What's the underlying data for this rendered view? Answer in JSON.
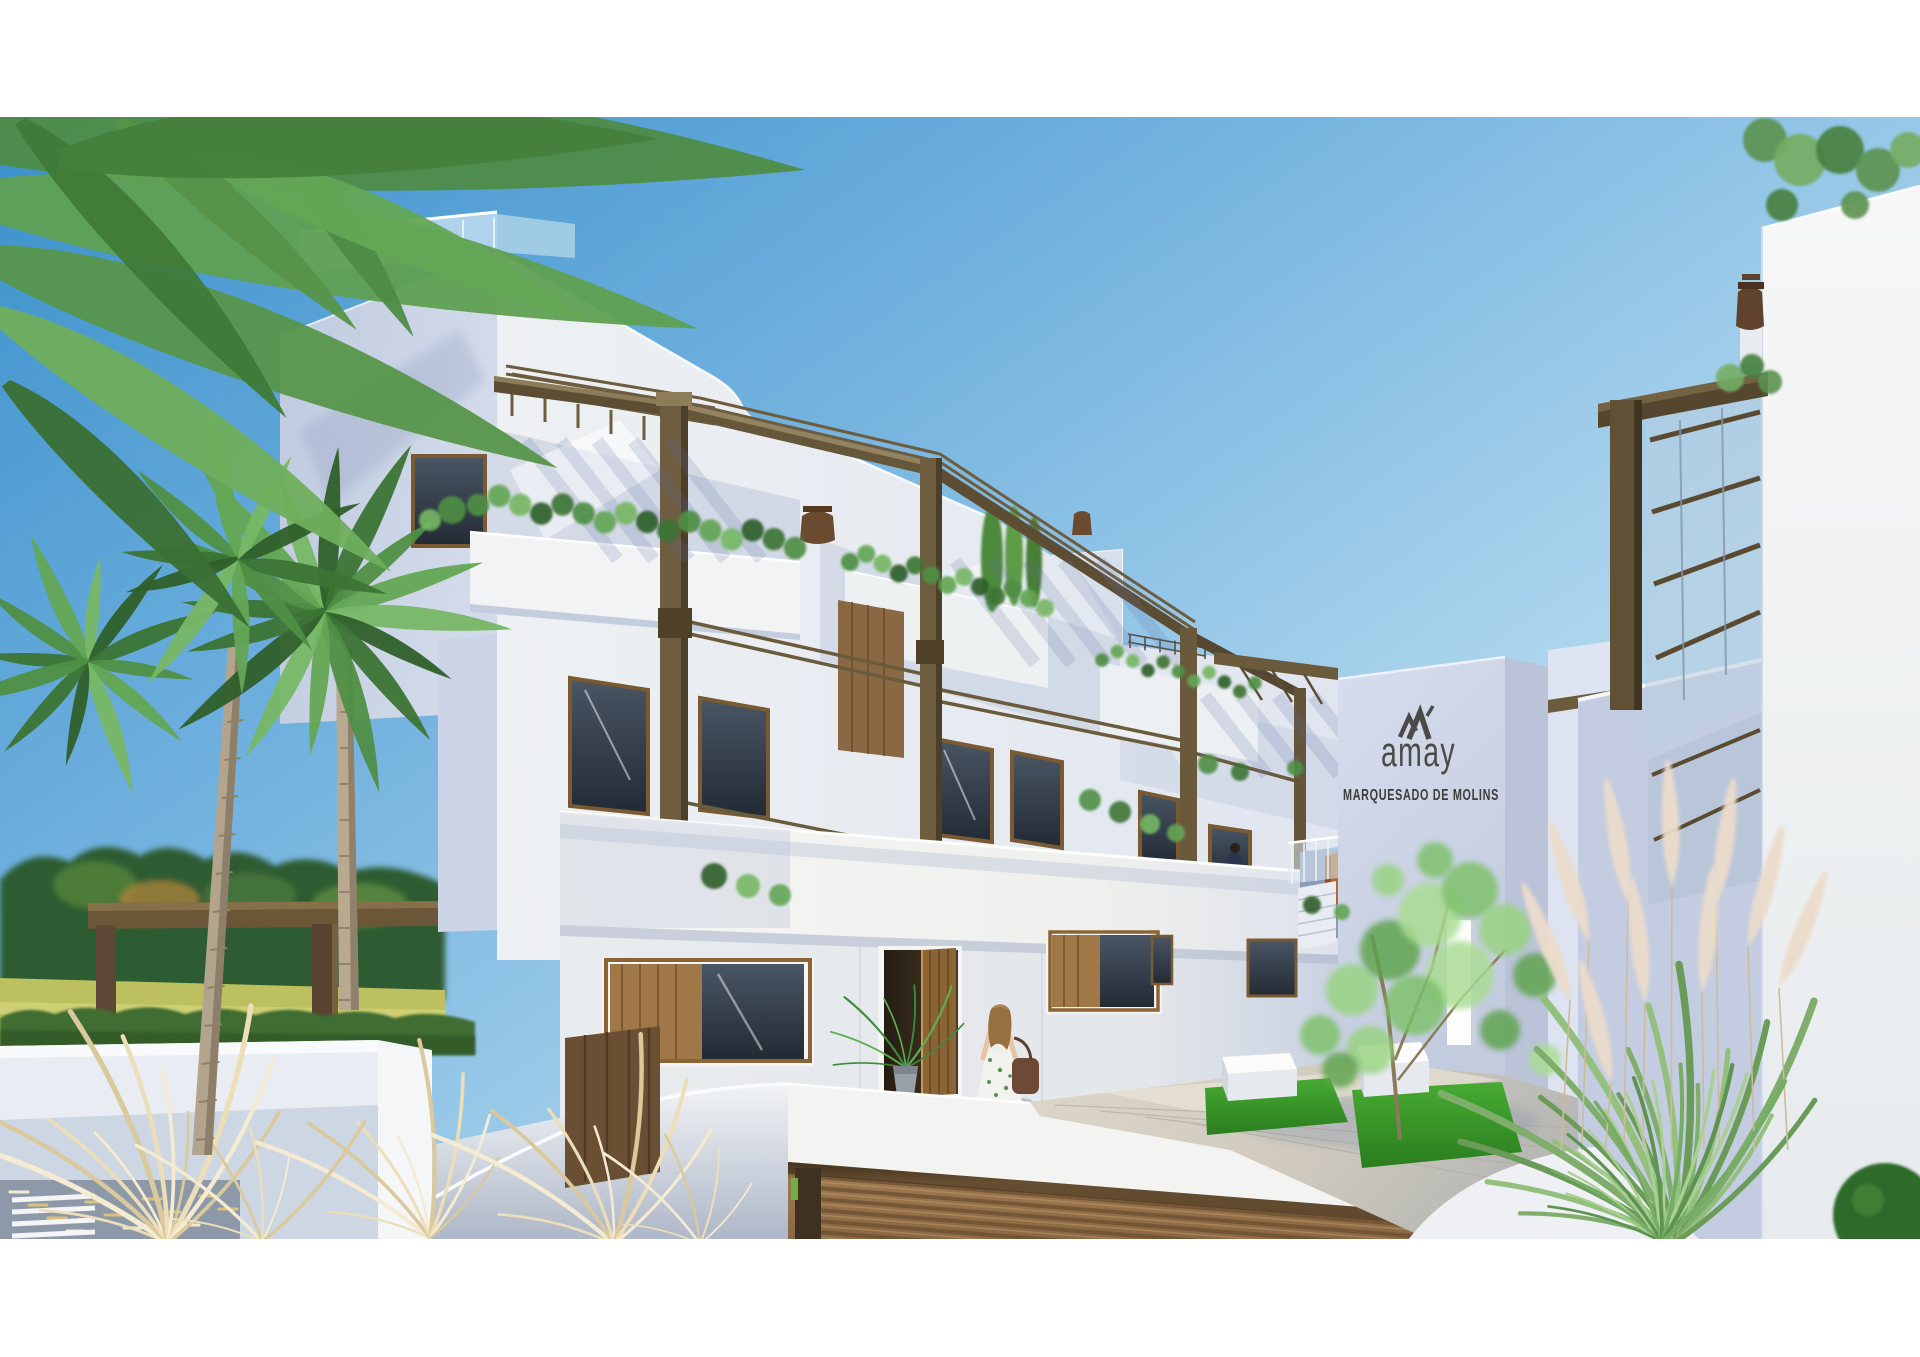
{
  "image": {
    "kind": "architectural-exterior-render",
    "letterbox_color": "#ffffff"
  },
  "signage": {
    "brand": "amay",
    "development": "MARQUESADO DE MOLINS",
    "text_color": "#4a4a46"
  },
  "palette": {
    "sky_deep": "#3b90cb",
    "sky_pale": "#d2e9f5",
    "wall_bright": "#f3f5f5",
    "wall_shadow": "#c8d2e5",
    "pergola_bronze": "#6b5a3c",
    "wood_frame": "#8a6435",
    "garage_wood": "#9c7850",
    "lawn_green": "#3da32d",
    "palm_green": "#4f8f44",
    "plume_cream": "#ecdccb",
    "meadow_yellow": "#bcc05e"
  },
  "scene": {
    "sky": "clear gradient sky",
    "left": "palm trees over meadow, treeline, clipped hedge and white garden wall with timber pergola",
    "center": "white three-storey residential block with stepped roofline, bronze pergola frames, planted balconies and roof-glass balustrade",
    "entrance": "open timber door with potted palm",
    "right": "gable wall with brand signage, white wing with lean-to pergola and palm fronds",
    "foreground": "paved courtyard with lawn squares, white cube benches, ornamental tree, pampas grasses, garage ramp with slatted timber door",
    "figures": {
      "woman_with_bag_at_entrance": true,
      "resident_on_walkway": true
    }
  }
}
